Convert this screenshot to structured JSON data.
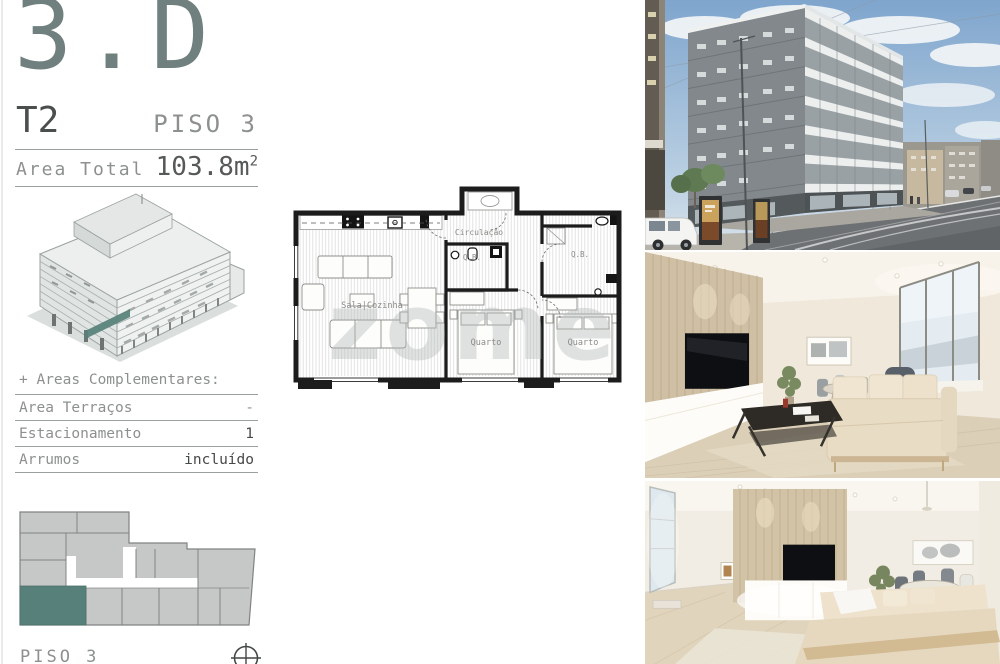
{
  "header": {
    "unit_code": "3.D",
    "typology": "T2",
    "floor_label": "PISO 3",
    "area_label": "Area Total",
    "area_value": "103.8m",
    "area_exponent": "2"
  },
  "complementares": {
    "title": "+ Areas Complementares:",
    "rows": [
      {
        "label": "Area Terraços",
        "value": "-"
      },
      {
        "label": "Estacionamento",
        "value": "1"
      },
      {
        "label": "Arrumos",
        "value": "incluído"
      }
    ]
  },
  "keyplan": {
    "caption": "PISO 3"
  },
  "floorplan": {
    "labels": {
      "circulacao": "Circulação",
      "sala_cozinha": "Sala|Cozinha",
      "quarto_1": "Quarto",
      "quarto_2": "Quarto",
      "qb_1": "Q.B.",
      "qb_2": "Q.B."
    },
    "watermark": "zome"
  },
  "colors": {
    "accent_teal": "#57807a",
    "keyplan_gray": "#c6c8c7",
    "text_gray": "#8c918f",
    "text_dark": "#454947",
    "plan_wall_black": "#1c1c1c"
  },
  "icons": {
    "compass": "compass-icon"
  }
}
